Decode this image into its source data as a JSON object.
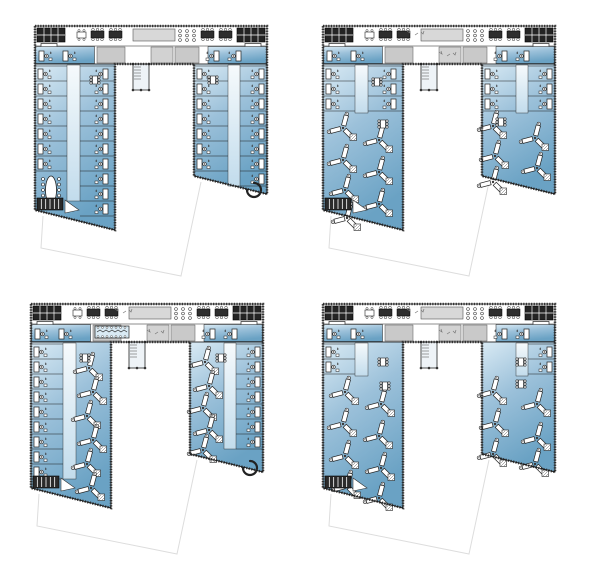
{
  "document": {
    "background": "#ffffff",
    "description": "Sheet of four U-shaped office building floor-plan variants arranged in a 2x2 grid; each plan shows a top head block with cores and meeting rooms, two angled office wings filled with blue, furniture symbols, and a faint site outline below the wings"
  },
  "colors": {
    "paper": "#ffffff",
    "blue_light": "#d9eaf4",
    "blue_mid": "#9cc1da",
    "blue_dark": "#6aa2c4",
    "corridor_light": "#eef5fa",
    "corridor_dark": "#c2dcec",
    "core_gray": "#c9c9c9",
    "hall_gray": "#d8d8d8",
    "band_gray": "#e9e9e9",
    "wall_dark": "#1f1f1f",
    "facade_dark": "#383838",
    "furniture_stroke": "#222222",
    "furniture_dark": "#3a3a3a",
    "site_line": "#dddddd"
  },
  "plans": [
    {
      "id": "top-left",
      "name": "floor-plan-variant-1",
      "layout": "cellular-offices-both-wings",
      "grid": {
        "row": 0,
        "col": 0
      },
      "left_wing": {
        "outer_rooms": 7,
        "inner_rooms": 10,
        "meeting_room_bottom": true,
        "lounge_bottom": false
      },
      "right_wing": {
        "inner_rooms": 7,
        "outer_rooms": 8,
        "meeting_room_bottom": false,
        "lounge_bottom": true
      },
      "corridor_left_end": 183,
      "corridor_right_end": 168,
      "clusters_left": [],
      "clusters_right": [],
      "dot_tables": [
        [
          58,
          56
        ],
        [
          176,
          56
        ]
      ],
      "head_extra_table": false,
      "head_scatter": false
    },
    {
      "id": "top-right",
      "name": "floor-plan-variant-2",
      "layout": "cellular-top-open-plan-bottom",
      "grid": {
        "row": 0,
        "col": 1
      },
      "left_wing": {
        "outer_rooms": 3,
        "inner_rooms": 3,
        "meeting_room_bottom": false,
        "lounge_bottom": false
      },
      "right_wing": {
        "inner_rooms": 3,
        "outer_rooms": 3,
        "meeting_room_bottom": false,
        "lounge_bottom": false
      },
      "corridor_left_end": 95,
      "corridor_right_end": 95,
      "clusters_left": [
        [
          22,
          110
        ],
        [
          58,
          122
        ],
        [
          22,
          142
        ],
        [
          58,
          154
        ],
        [
          24,
          172
        ],
        [
          58,
          186
        ],
        [
          26,
          200
        ]
      ],
      "clusters_right": [
        [
          172,
          108
        ],
        [
          214,
          120
        ],
        [
          174,
          138
        ],
        [
          216,
          150
        ],
        [
          172,
          164
        ]
      ],
      "dot_tables": [
        [
          58,
          100
        ],
        [
          176,
          98
        ],
        [
          52,
          58
        ]
      ],
      "head_extra_table": false,
      "head_scatter": true
    },
    {
      "id": "bottom-left",
      "name": "floor-plan-variant-3",
      "layout": "cellular-outer-open-plan-inner",
      "grid": {
        "row": 1,
        "col": 0
      },
      "left_wing": {
        "outer_rooms": 9,
        "inner_rooms": 0,
        "meeting_room_bottom": false,
        "lounge_bottom": false
      },
      "right_wing": {
        "inner_rooms": 0,
        "outer_rooms": 7,
        "meeting_room_bottom": false,
        "lounge_bottom": true
      },
      "corridor_left_end": 183,
      "corridor_right_end": 153,
      "clusters_left": [
        [
          60,
          72
        ],
        [
          64,
          96
        ],
        [
          58,
          120
        ],
        [
          64,
          144
        ],
        [
          58,
          168
        ],
        [
          62,
          192
        ]
      ],
      "clusters_right": [
        [
          176,
          66
        ],
        [
          180,
          90
        ],
        [
          174,
          112
        ],
        [
          180,
          134
        ],
        [
          174,
          154
        ]
      ],
      "dot_tables": [
        [
          52,
          56
        ],
        [
          188,
          56
        ]
      ],
      "head_extra_table": true,
      "head_scatter": true
    },
    {
      "id": "bottom-right",
      "name": "floor-plan-variant-4",
      "layout": "open-plan-both-wings",
      "grid": {
        "row": 1,
        "col": 1
      },
      "left_wing": {
        "outer_rooms": 2,
        "inner_rooms": 0,
        "meeting_room_bottom": false,
        "lounge_bottom": false
      },
      "right_wing": {
        "inner_rooms": 0,
        "outer_rooms": 2,
        "meeting_room_bottom": false,
        "lounge_bottom": false
      },
      "corridor_left_end": 80,
      "corridor_right_end": 80,
      "clusters_left": [
        [
          24,
          96
        ],
        [
          60,
          108
        ],
        [
          22,
          128
        ],
        [
          58,
          140
        ],
        [
          24,
          160
        ],
        [
          60,
          172
        ],
        [
          26,
          190
        ],
        [
          58,
          202
        ]
      ],
      "clusters_right": [
        [
          172,
          96
        ],
        [
          216,
          108
        ],
        [
          174,
          128
        ],
        [
          216,
          142
        ],
        [
          172,
          158
        ],
        [
          214,
          168
        ]
      ],
      "dot_tables": [
        [
          58,
          60
        ],
        [
          196,
          60
        ],
        [
          60,
          84
        ],
        [
          196,
          82
        ]
      ],
      "head_extra_table": false,
      "head_scatter": true
    }
  ],
  "grid_positions": [
    {
      "id": "top-left",
      "x": 30,
      "y": 18
    },
    {
      "id": "top-right",
      "x": 318,
      "y": 18
    },
    {
      "id": "bottom-left",
      "x": 26,
      "y": 296
    },
    {
      "id": "bottom-right",
      "x": 318,
      "y": 296
    }
  ]
}
